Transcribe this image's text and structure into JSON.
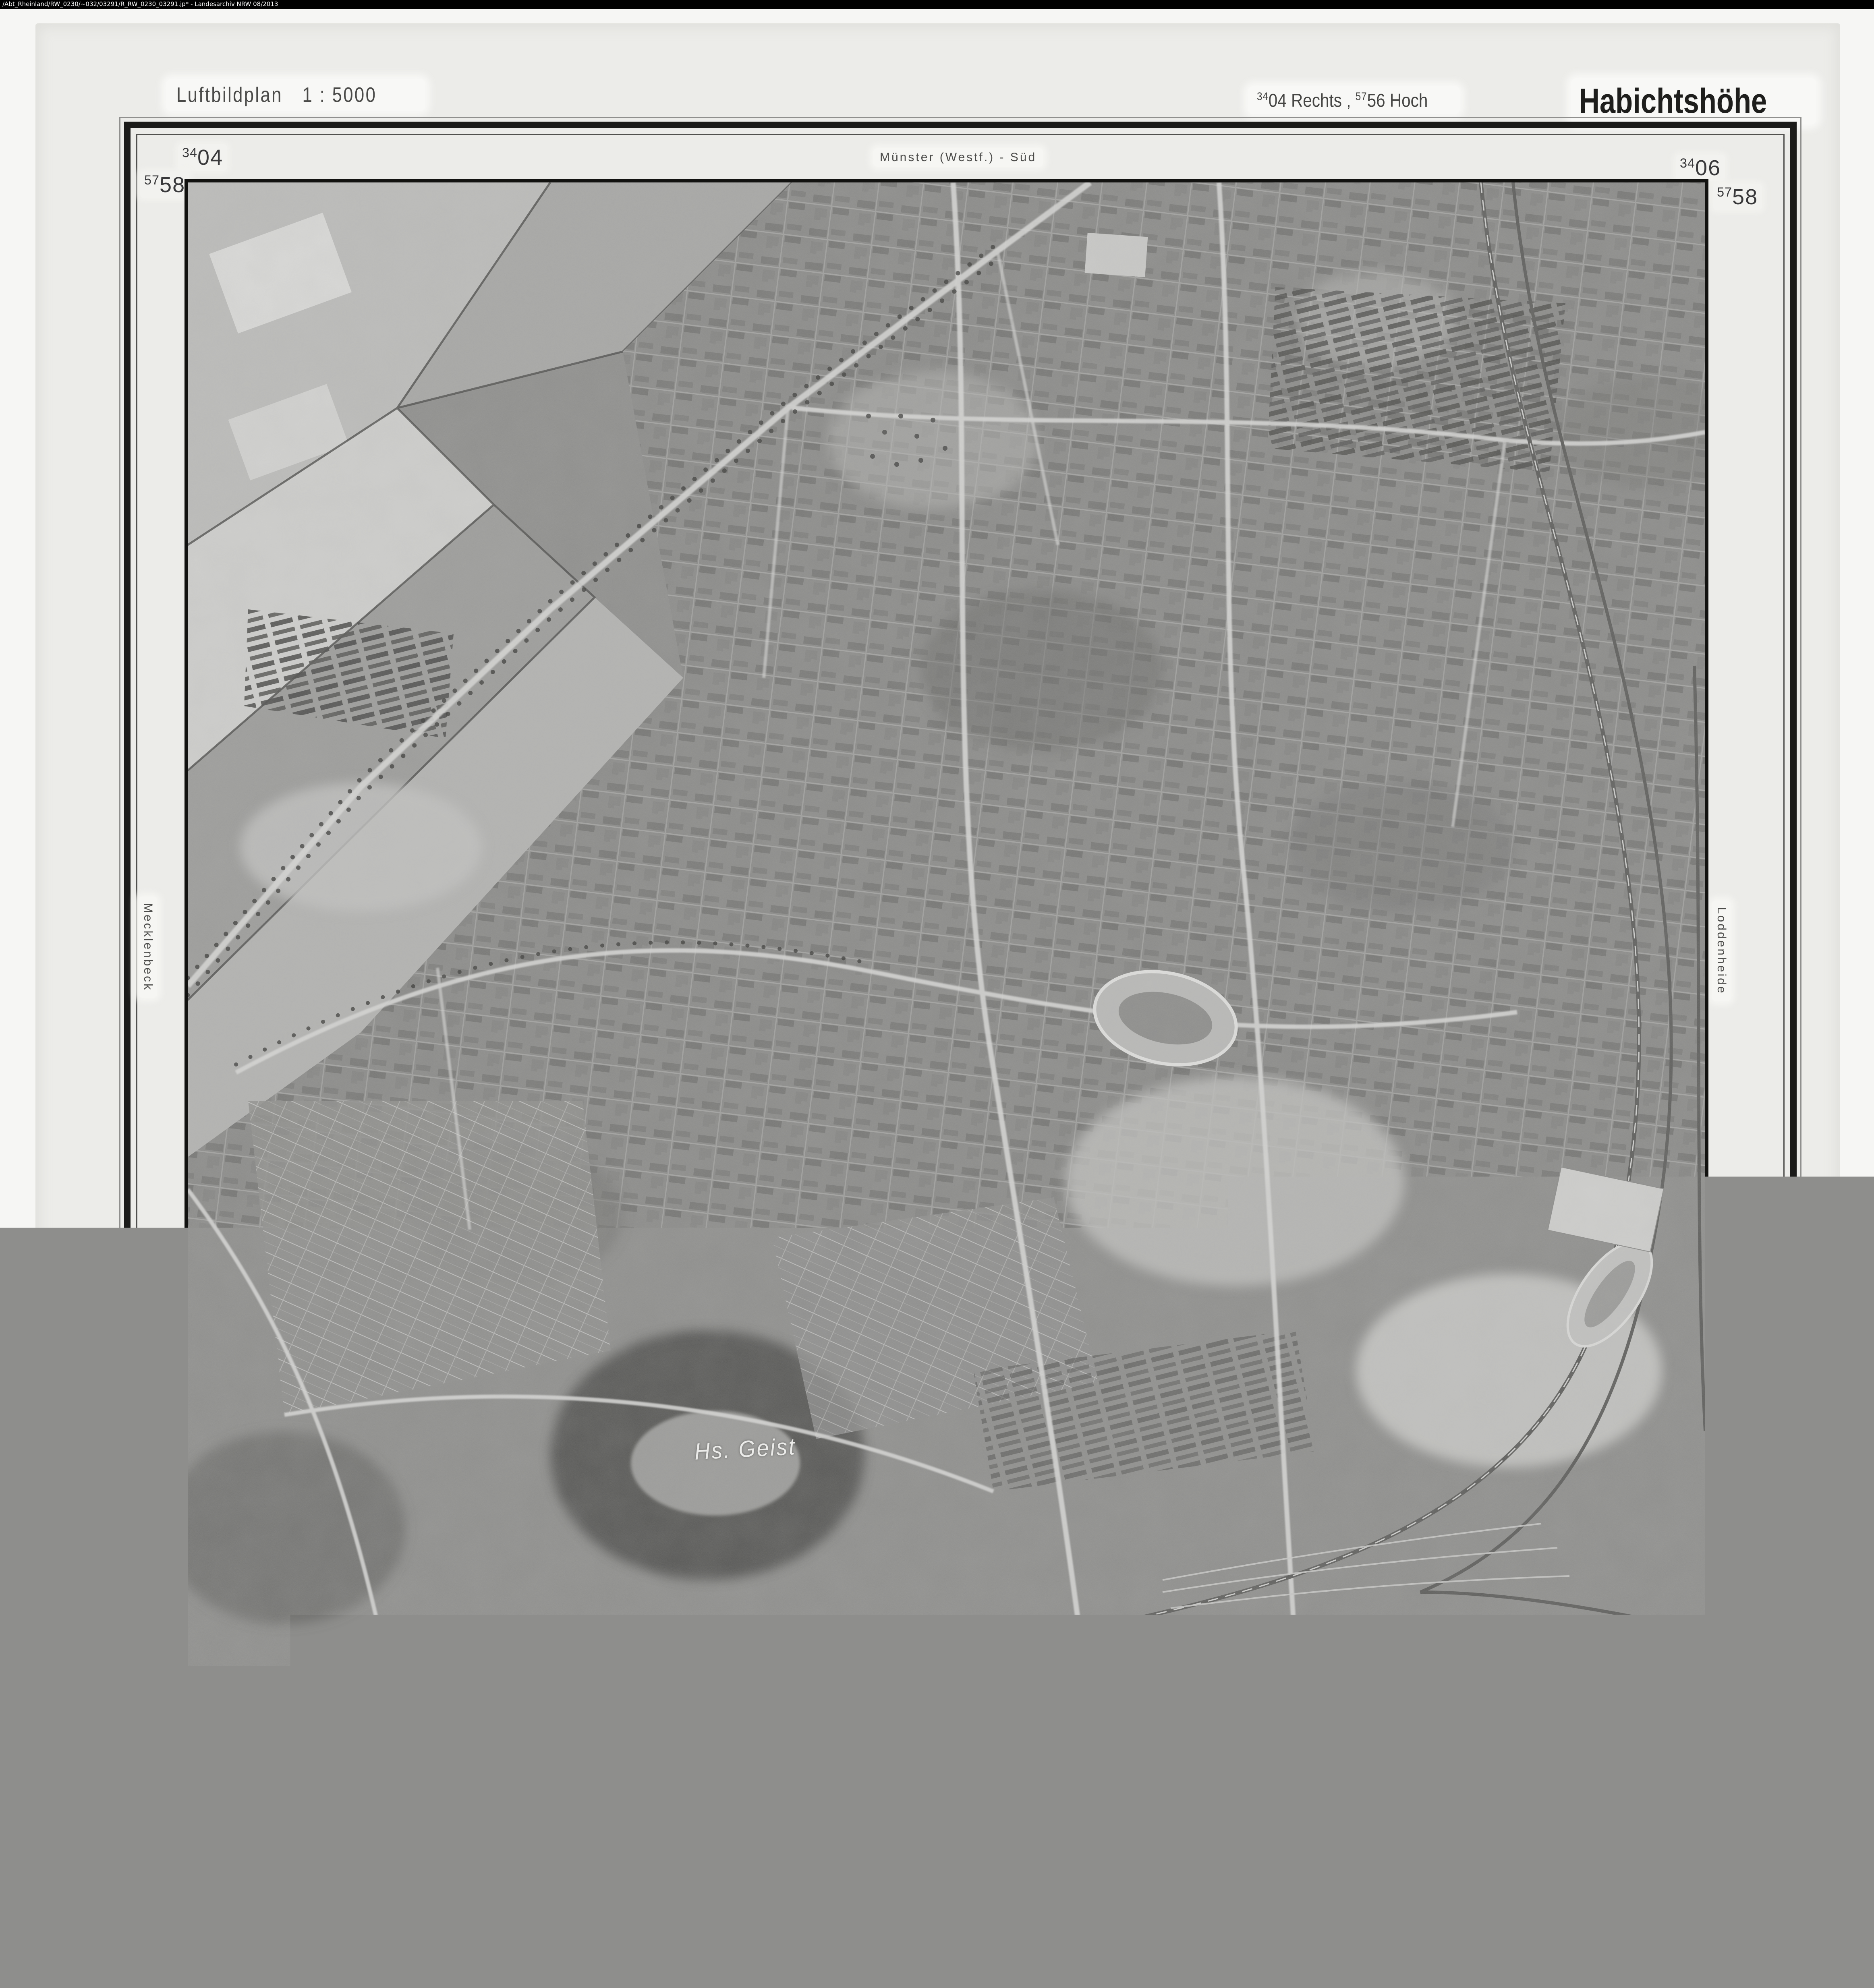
{
  "viewer_bar": {
    "path_text": "/Abt_Rheinland/RW_0230/~032/03291/R_RW_0230_03291.jp* -  Landesarchiv NRW  08/2013"
  },
  "header": {
    "plan_type": "Luftbildplan",
    "plan_scale": "1 : 5000",
    "grid_rechts_sup": "34",
    "grid_rechts_num": "04",
    "grid_rechts_word": "Rechts ,",
    "grid_hoch_sup": "57",
    "grid_hoch_num": "56",
    "grid_hoch_word": "Hoch",
    "sheet_name": "Habichtshöhe"
  },
  "frame_labels": {
    "top": "Münster (Westf.) - Süd",
    "left": "Mecklenbeck",
    "right": "Loddenheide",
    "bottom": "Vennheide"
  },
  "corner_coords": {
    "tl_x": {
      "sup": "34",
      "num": "04"
    },
    "tl_y": {
      "sup": "57",
      "num": "58"
    },
    "tr_x": {
      "sup": "34",
      "num": "06"
    },
    "tr_y": {
      "sup": "57",
      "num": "58"
    },
    "bl_x": {
      "sup": "34",
      "num": "04"
    },
    "bl_y": {
      "sup": "57",
      "num": "56"
    },
    "br_x": {
      "sup": "34",
      "num": "06"
    },
    "br_y": {
      "sup": "57",
      "num": "56"
    }
  },
  "photo": {
    "place_label": "Hs. Geist"
  },
  "footer": {
    "survey_date": "Aufgen. : 9. Mai 1954",
    "scale_title": "1 : 5000",
    "scale_ticks": [
      "100",
      "0",
      "100",
      "200",
      "300",
      "400",
      "500 m"
    ],
    "rectification_line1": "Entzerrungsgrundlage :",
    "rectification_line2": "Katasterplankarte",
    "publisher": "Plan und Karte G.m.b.H.  Münster (Westf.)",
    "topo_ref": "Top. Karte 1 : 25 000  Nr.  4011",
    "copyright_line1": "Nachdruck und Vervielfältigung ( auch einzelner Teile ) sowie die",
    "copyright_line2": "Anfertigung von Vergrößerungen oder Verkleinerungen sind verboten."
  },
  "colors": {
    "topbar_bg": "#000000",
    "topbar_text": "#ffffff",
    "sheet_bg": "#ecece9",
    "frame_dark": "#1b1b19",
    "label_ink": "#3c3c3a",
    "photo_base": "#8e8e8c"
  }
}
